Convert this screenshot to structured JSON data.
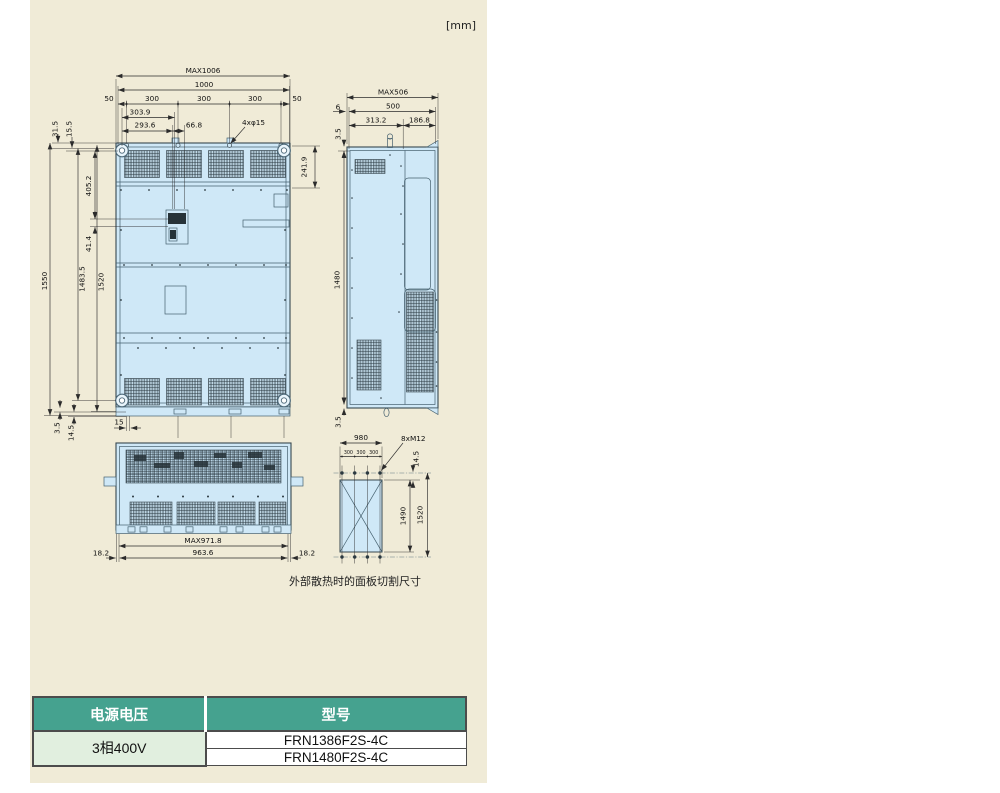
{
  "unit_label": "[mm]",
  "caption": "外部散热时的面板切割尺寸",
  "colors": {
    "panel_bg": "#f0ebd7",
    "drawing_fill": "#cfe8f7",
    "line": "#37474f",
    "table_header_bg": "#45a28f",
    "table_header_text": "#ffffff",
    "table_voltage_bg": "#e1efdf",
    "table_border": "#4c4c4c"
  },
  "front_view": {
    "dims": {
      "max_w": "MAX1006",
      "w": "1000",
      "m_l": "50",
      "p": [
        "300",
        "300",
        "300"
      ],
      "m_r": "50",
      "a": "303.9",
      "b": "293.6",
      "c": "66.8",
      "holes": "4xφ15",
      "tl1": "31.5",
      "tl2": "15.5",
      "h1": "1550",
      "h2": "1483.5",
      "h3": "1520",
      "v1": "405.2",
      "v2": "41.4",
      "r1": "241.9",
      "bl1": "3.5",
      "bl2": "14.5",
      "foot": "15"
    }
  },
  "side_view": {
    "dims": {
      "max_d": "MAX506",
      "off": "6",
      "d": "500",
      "d1": "313.2",
      "d2": "186.8",
      "t": "3.5",
      "h": "1480",
      "b": "3.5"
    }
  },
  "bottom_view": {
    "dims": {
      "l": "18.2",
      "max_w": "MAX971.8",
      "w": "963.6",
      "r": "18.2"
    }
  },
  "cutout_view": {
    "dims": {
      "w": "980",
      "p": [
        "300",
        "300",
        "300"
      ],
      "bolts": "8xM12",
      "off": "14.5",
      "h": "1490",
      "hp": "1520"
    }
  },
  "table": {
    "headers": [
      "电源电压",
      "型号"
    ],
    "voltage": "3相400V",
    "models": [
      "FRN1386F2S-4C",
      "FRN1480F2S-4C"
    ]
  }
}
